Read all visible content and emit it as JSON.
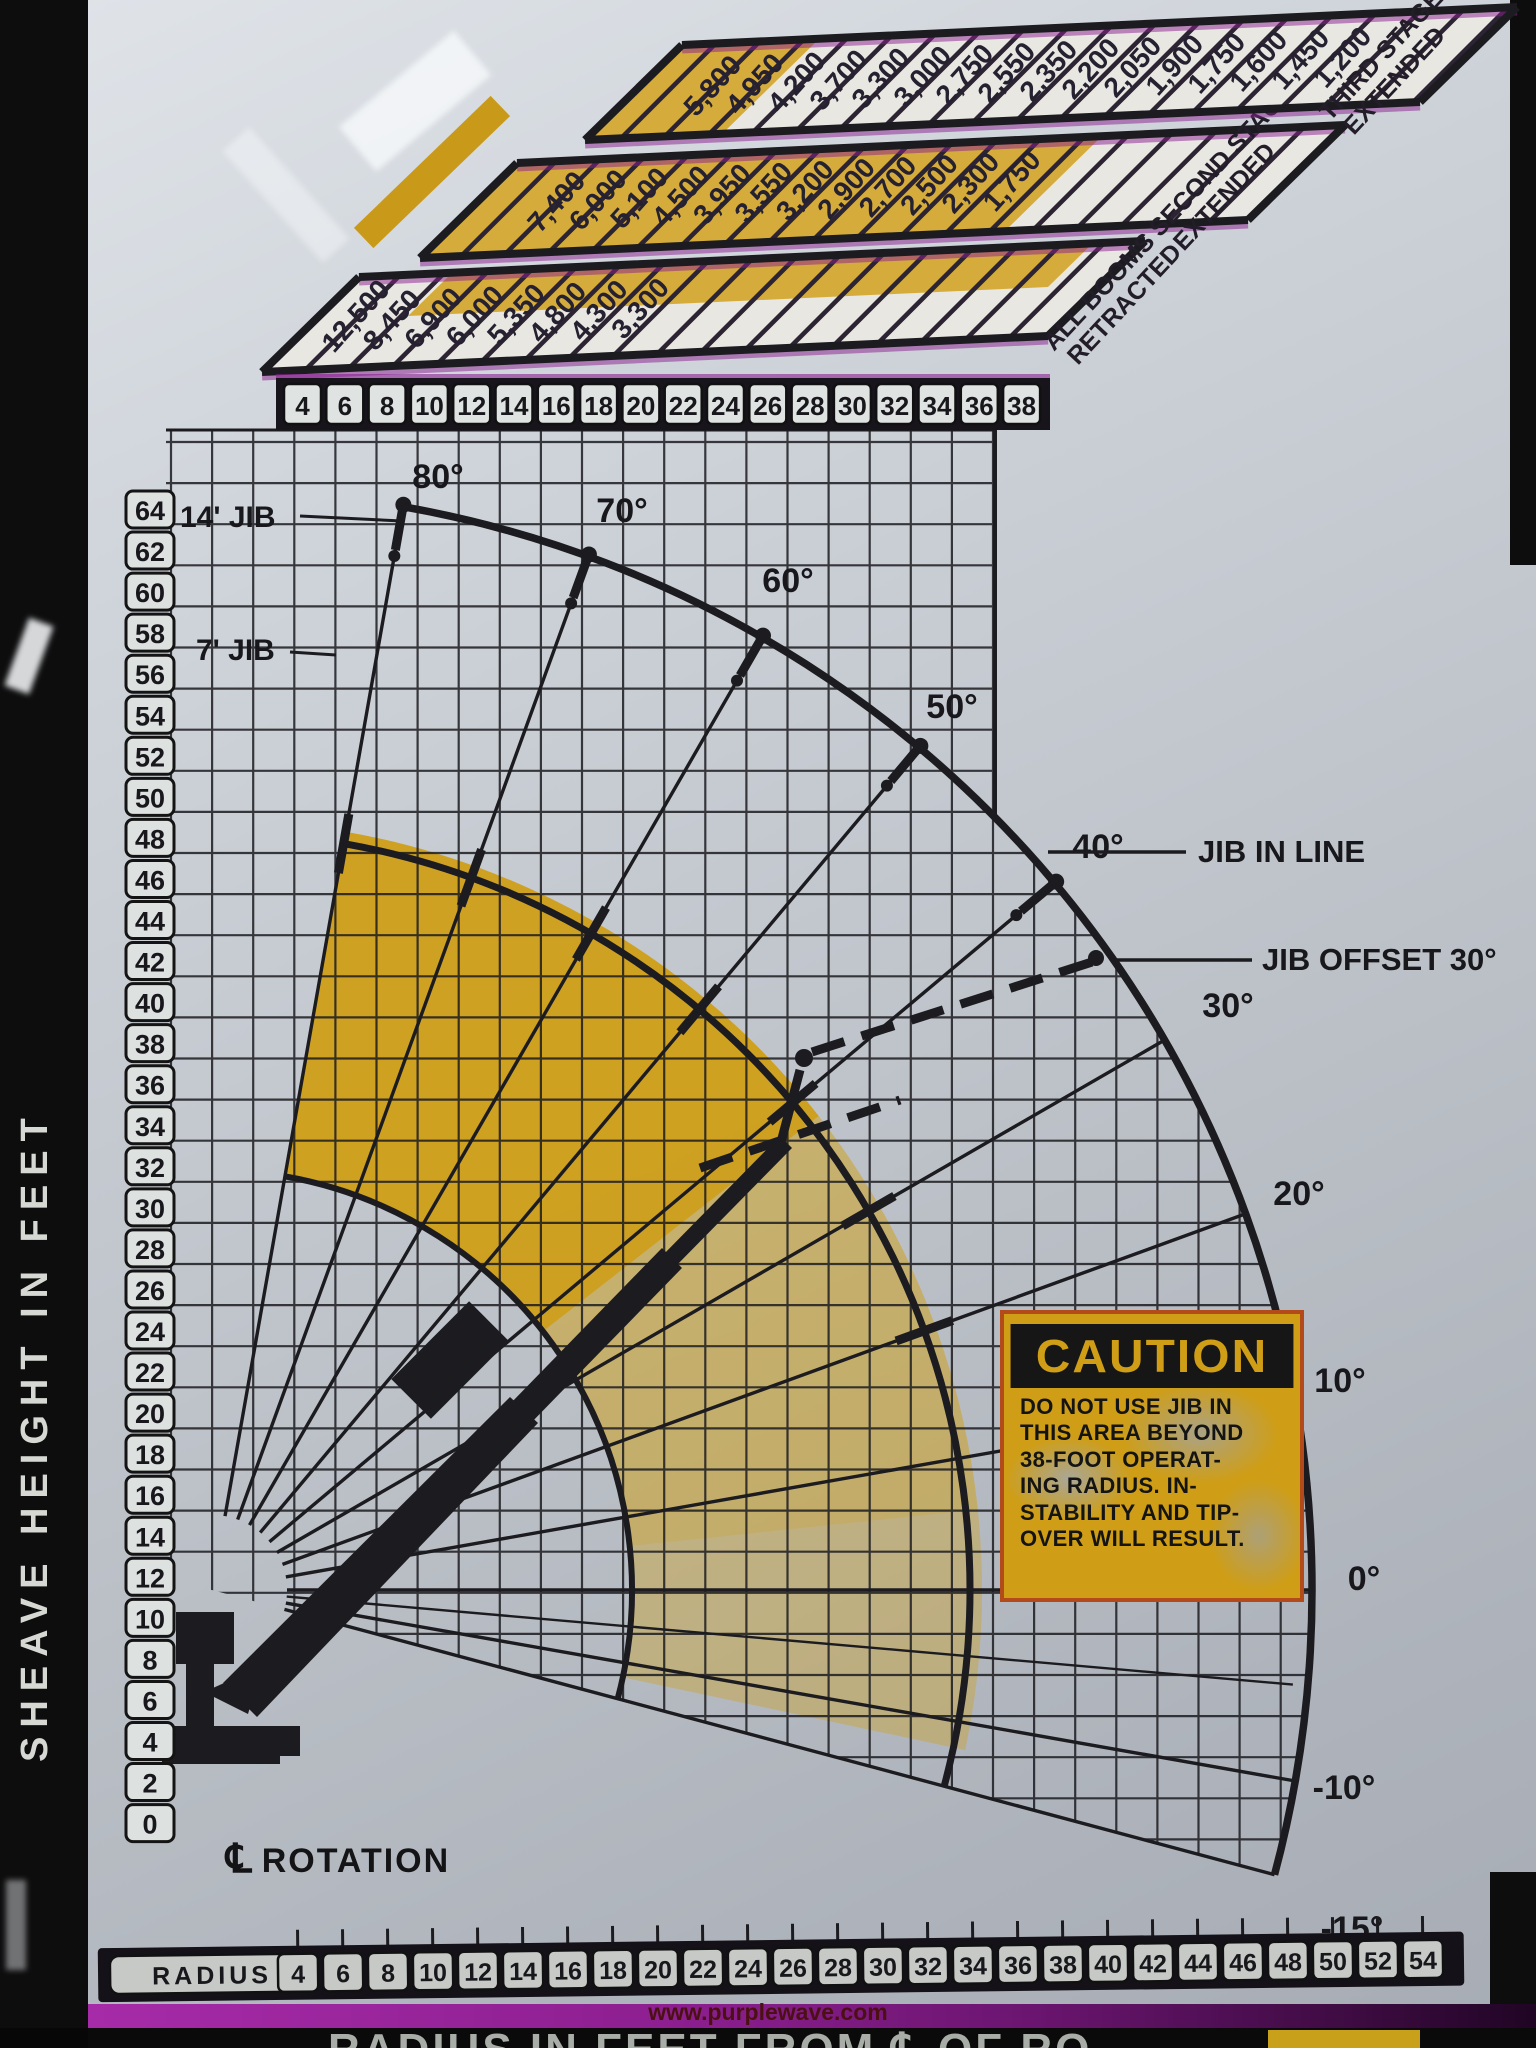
{
  "left_axis": {
    "title": "SHEAVE HEIGHT IN FEET",
    "ticks": [
      64,
      62,
      60,
      58,
      56,
      54,
      52,
      50,
      48,
      46,
      44,
      42,
      40,
      38,
      36,
      34,
      32,
      30,
      28,
      26,
      24,
      22,
      20,
      18,
      16,
      14,
      12,
      10,
      8,
      6,
      4,
      2,
      0
    ]
  },
  "top_table": {
    "radius_header": [
      4,
      6,
      8,
      10,
      12,
      14,
      16,
      18,
      20,
      22,
      24,
      26,
      28,
      30,
      32,
      34,
      36,
      38
    ],
    "rows": [
      {
        "label": "ALL BOOMS RETRACTED",
        "values": [
          "12,500",
          "8,450",
          "6,900",
          "6,000",
          "5,350",
          "4,800",
          "4,300",
          "3,300"
        ]
      },
      {
        "label": "SECOND STAGE EXTENDED",
        "values": [
          "7,400",
          "6,000",
          "5,100",
          "4,500",
          "3,950",
          "3,550",
          "3,200",
          "2,900",
          "2,700",
          "2,500",
          "2,300",
          "1,750"
        ]
      },
      {
        "label": "THIRD STAGE EXTENDED",
        "values": [
          "5,800",
          "4,950",
          "4,200",
          "3,700",
          "3,300",
          "3,000",
          "2,750",
          "2,550",
          "2,350",
          "2,200",
          "2,050",
          "1,900",
          "1,750",
          "1,600",
          "1,450",
          "1,200"
        ]
      }
    ]
  },
  "angle_labels": [
    "80°",
    "70°",
    "60°",
    "50°",
    "40°",
    "30°",
    "20°",
    "10°",
    "0°",
    "-10°",
    "-15°"
  ],
  "jib_labels": {
    "jib_14": "14' JIB",
    "jib_7": "7' JIB",
    "jib_in_line": "JIB IN LINE",
    "jib_offset": "JIB OFFSET 30°"
  },
  "caution": {
    "title": "CAUTION",
    "body": "DO NOT USE JIB IN\nTHIS AREA BEYOND\n38-FOOT OPERAT-\nING RADIUS. IN-\nSTABILITY AND TIP-\nOVER WILL RESULT."
  },
  "bottom_axis": {
    "label": "RADIUS",
    "ticks": [
      4,
      6,
      8,
      10,
      12,
      14,
      16,
      18,
      20,
      22,
      24,
      26,
      28,
      30,
      32,
      34,
      36,
      38,
      40,
      42,
      44,
      46,
      48,
      50,
      52,
      54
    ]
  },
  "rotation": {
    "cl_symbol": "℄",
    "label": "ROTATION"
  },
  "footer": {
    "banner": "RADIUS IN FEET FROM ℄ OF RO",
    "watermark": "www.purplewave.com"
  },
  "colors": {
    "ink": "#1c1c20",
    "plate_silver": "#c6cbd2",
    "gold": "#cf9d12",
    "magenta_band": "#8d1f90",
    "caution_yellow": "#cf9e16",
    "caution_border": "#b34a1a"
  },
  "chart_data": {
    "type": "table",
    "title": "Crane working range diagram with load capacities (lb) by operating radius (ft)",
    "xlabel": "RADIUS IN FEET FROM ℄ OF ROTATION",
    "ylabel": "SHEAVE HEIGHT IN FEET",
    "x_axis": {
      "ticks": [
        4,
        6,
        8,
        10,
        12,
        14,
        16,
        18,
        20,
        22,
        24,
        26,
        28,
        30,
        32,
        34,
        36,
        38,
        40,
        42,
        44,
        46,
        48,
        50,
        52,
        54
      ],
      "range": [
        0,
        54
      ]
    },
    "y_axis": {
      "ticks": [
        0,
        2,
        4,
        6,
        8,
        10,
        12,
        14,
        16,
        18,
        20,
        22,
        24,
        26,
        28,
        30,
        32,
        34,
        36,
        38,
        40,
        42,
        44,
        46,
        48,
        50,
        52,
        54,
        56,
        58,
        60,
        62,
        64
      ],
      "range": [
        0,
        64
      ]
    },
    "boom_angle_lines_deg": [
      80,
      70,
      60,
      50,
      40,
      30,
      20,
      10,
      0,
      -10,
      -15
    ],
    "series": [
      {
        "name": "ALL BOOMS RETRACTED",
        "radii_ft": [
          4,
          6,
          8,
          10,
          12,
          14,
          16,
          18
        ],
        "capacity_lb": [
          12500,
          8450,
          6900,
          6000,
          5350,
          4800,
          4300,
          3300
        ]
      },
      {
        "name": "SECOND STAGE EXTENDED",
        "radii_ft": [
          8,
          10,
          12,
          14,
          16,
          18,
          20,
          22,
          24,
          26,
          28,
          30
        ],
        "capacity_lb": [
          7400,
          6000,
          5100,
          4500,
          3950,
          3550,
          3200,
          2900,
          2700,
          2500,
          2300,
          1750
        ]
      },
      {
        "name": "THIRD STAGE EXTENDED",
        "radii_ft": [
          8,
          10,
          12,
          14,
          16,
          18,
          20,
          22,
          24,
          26,
          28,
          30,
          32,
          34,
          36,
          38
        ],
        "capacity_lb": [
          5800,
          4950,
          4200,
          3700,
          3300,
          3000,
          2750,
          2550,
          2350,
          2200,
          2050,
          1900,
          1750,
          1600,
          1450,
          1200
        ]
      }
    ],
    "annotations": [
      "14' JIB",
      "7' JIB",
      "JIB IN LINE",
      "JIB OFFSET 30°",
      "℄ ROTATION",
      "CAUTION: DO NOT USE JIB IN THIS AREA BEYOND 38-FOOT OPERATING RADIUS. INSTABILITY AND TIP-OVER WILL RESULT."
    ],
    "legend_position": "none",
    "grid": true
  }
}
